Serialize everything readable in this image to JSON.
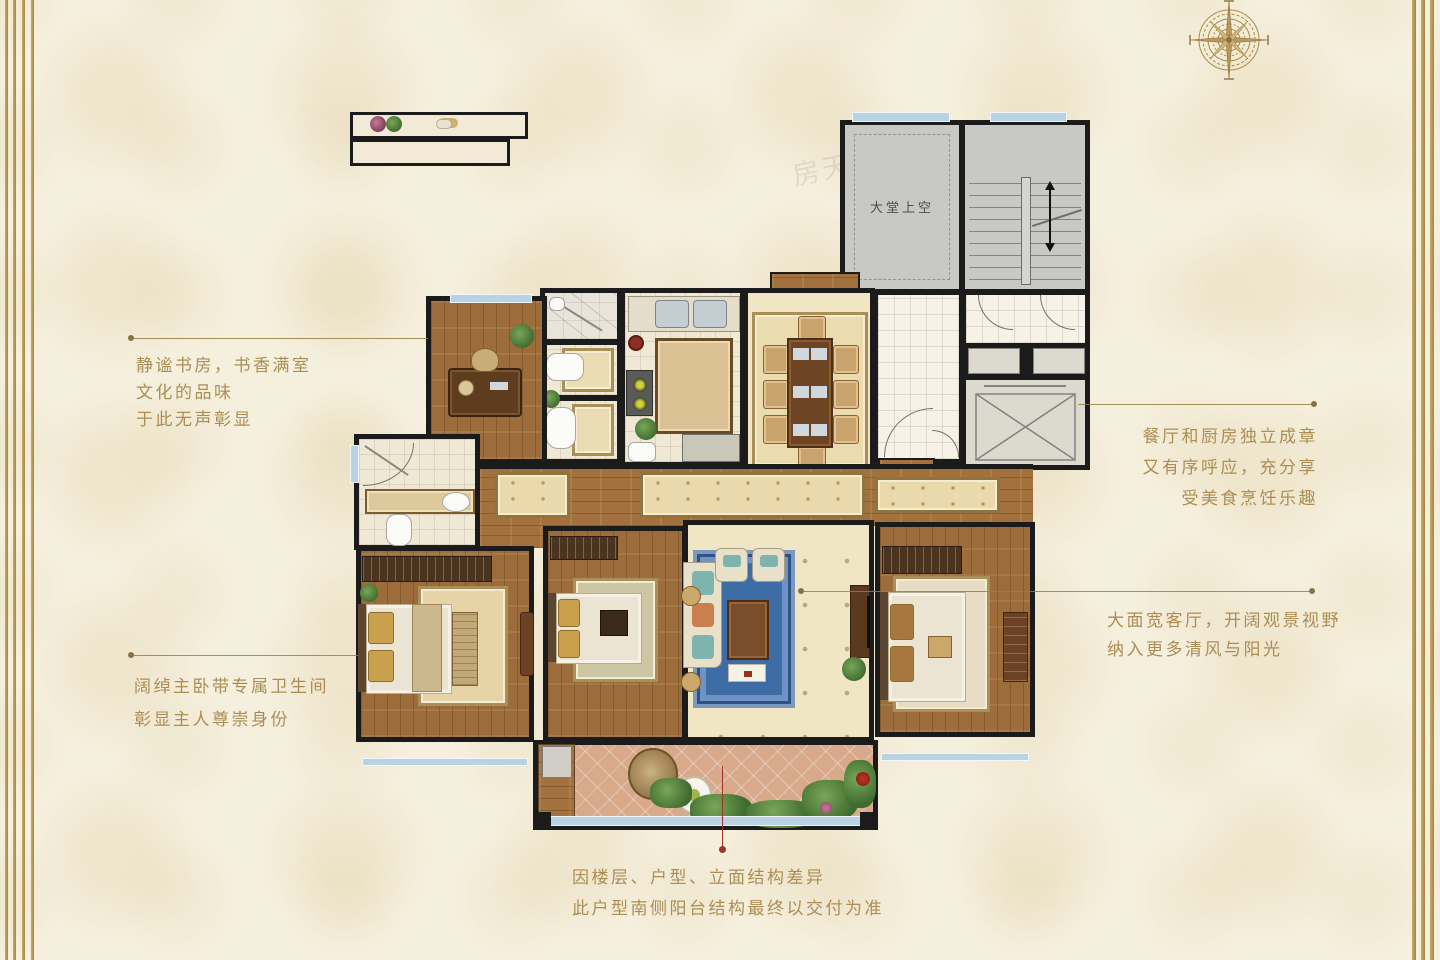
{
  "colors": {
    "background": "#f5efdd",
    "accent_gold": "#ab8e55",
    "wall_black": "#1b1b1b",
    "window_blue": "#b9d3e2",
    "leader_red": "#a03228",
    "rug_blue": "#3e6da6",
    "lobby_gray": "#c8c9c5",
    "wood_floor": "#9c6c3a",
    "balcony_terracotta": "#d9a98b"
  },
  "plan": {
    "labels": {
      "lobby_void": "大堂上空"
    }
  },
  "annotations": {
    "study": {
      "lines": [
        "静谧书房，书香满室",
        "文化的品味",
        "于此无声彰显"
      ]
    },
    "master": {
      "lines": [
        "阔绰主卧带专属卫生间",
        "彰显主人尊崇身份"
      ]
    },
    "dining_kitchen": {
      "lines": [
        "餐厅和厨房独立成章",
        "又有序呼应，充分享",
        "受美食烹饪乐趣"
      ]
    },
    "living": {
      "lines": [
        "大面宽客厅，开阔观景视野",
        "纳入更多清风与阳光"
      ]
    },
    "disclaimer": {
      "lines": [
        "因楼层、户型、立面结构差异",
        "此户型南侧阳台结构最终以交付为准"
      ]
    }
  },
  "watermarks": [
    {
      "text": "房天下 fang.com"
    },
    {
      "text": "房天下 fang.com"
    }
  ]
}
